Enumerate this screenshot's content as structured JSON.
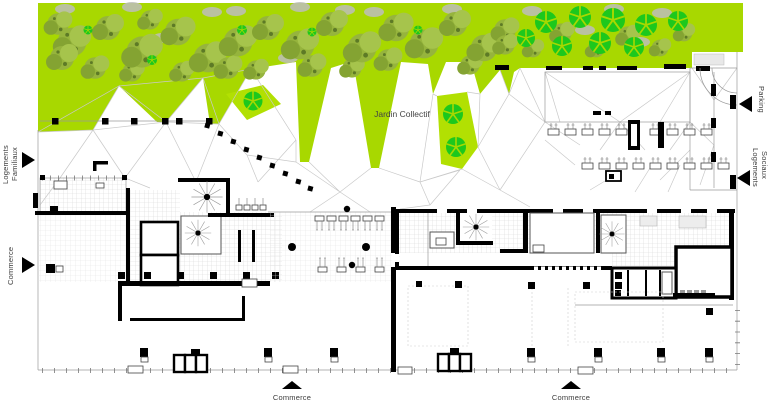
{
  "plan": {
    "garden_label": "Jardin Collectif",
    "edge_labels": {
      "left_top_line1": "Logements",
      "left_top_line2": "Familiaux",
      "left_bottom": "Commerce",
      "right_top": "Parking",
      "right_bottom_line1": "Logements",
      "right_bottom_line2": "Sociaux",
      "bottom_left": "Commerce",
      "bottom_right": "Commerce"
    },
    "colors": {
      "garden_green": "#a8d800",
      "garden_patch_green": "#b2e002",
      "tree_bright_green": "#1dc81d",
      "tree_olive_green": "#93b23c",
      "shrub_gray": "#bdbdbd",
      "wall_black": "#000000"
    }
  }
}
